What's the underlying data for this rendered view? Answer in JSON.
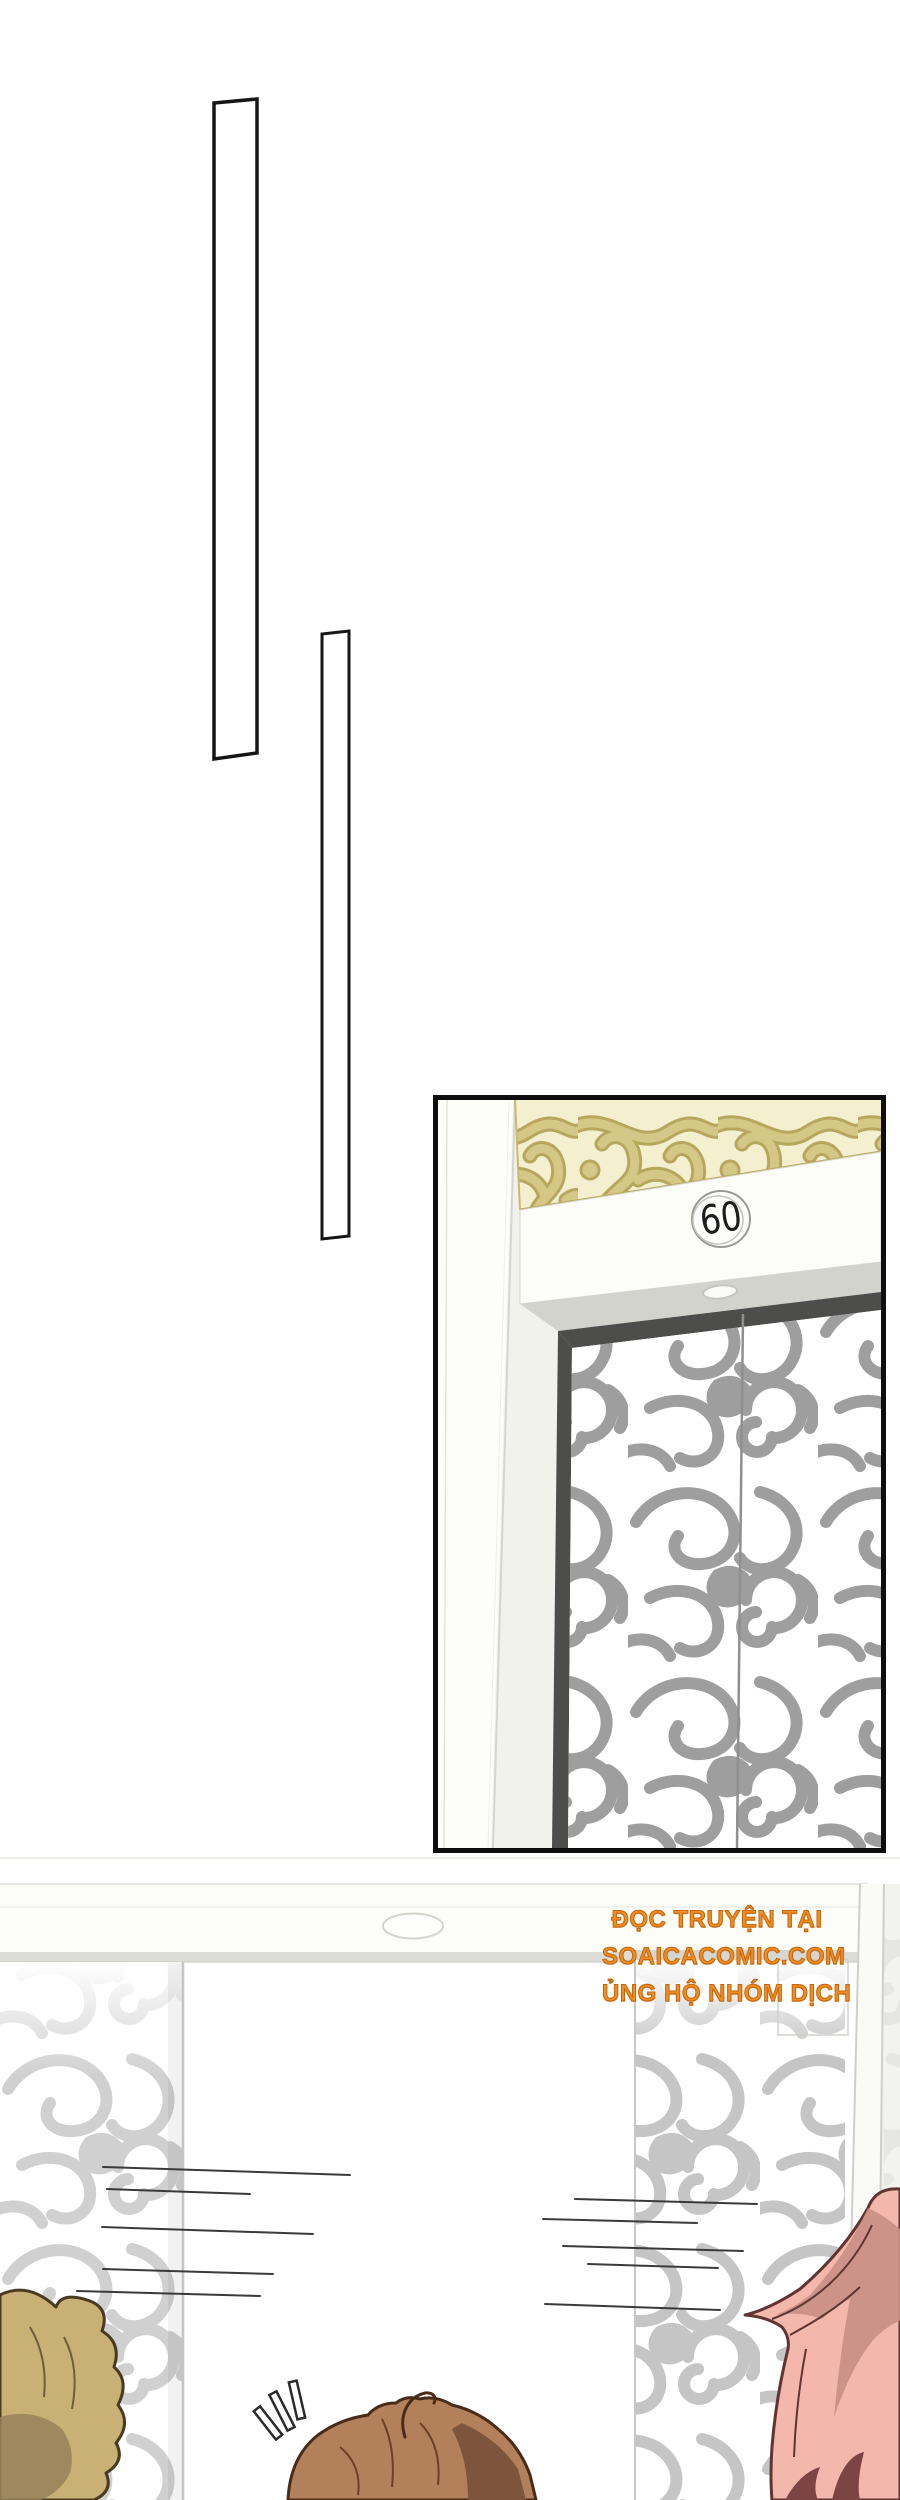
{
  "page": {
    "kind": "comic-page",
    "background": "#ffffff",
    "panel_count": 3
  },
  "elevator": {
    "floor_number": "60",
    "description": "elevator lintel with engraved gold lattice transom and cloud-pattern doors"
  },
  "bottom_scene": {
    "emphasis_marks": "!!!",
    "description": "elevator doors opening with speed lines, three character heads"
  },
  "credits": {
    "line1": "ĐỌC TRUYỆN TẠI",
    "line2": "SOAICACOMIC.COM",
    "line3": "ỦNG HỘ NHÓM DỊCH"
  },
  "colors": {
    "credit_orange": "#ef8d24",
    "credit_outline": "#c4660b",
    "ink": "#1d1d1d",
    "panel_border": "#0e0e0e",
    "lattice_tan": "#d5c887",
    "lattice_bg": "#f4efce",
    "swirl_gray": "#9e9e9e",
    "recess_dark": "#4d4d4b",
    "hair_tan": "#c9b176",
    "hair_brown": "#b3805c",
    "hair_pink": "#f3b8ab"
  }
}
